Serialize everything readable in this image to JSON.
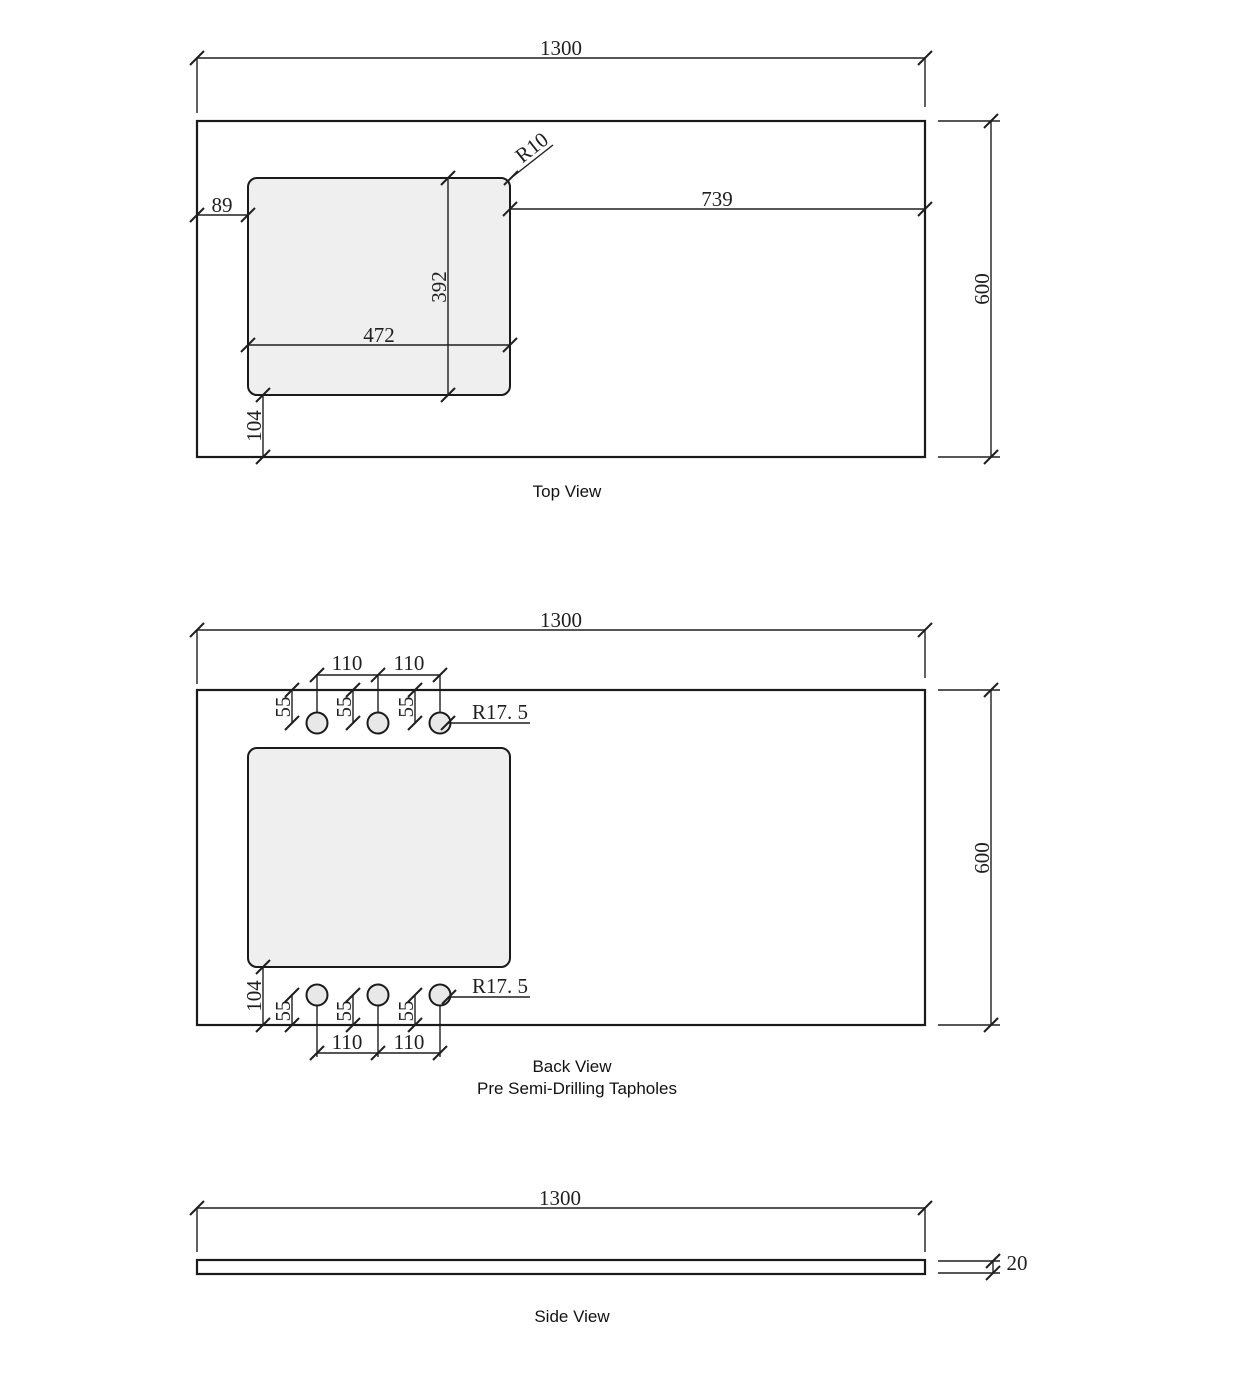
{
  "views": {
    "top": {
      "label": "Top View",
      "dims": {
        "width": "1300",
        "height": "600",
        "cutout_width": "472",
        "cutout_height": "392",
        "offset_left": "89",
        "offset_right": "739",
        "offset_bottom": "104",
        "corner_radius": "R10"
      }
    },
    "back": {
      "label": "Back View",
      "sublabel": "Pre Semi-Drilling Tapholes",
      "dims": {
        "width": "1300",
        "height": "600",
        "hole_pitch": "110",
        "hole_edge_offset": "55",
        "hole_radius": "R17. 5",
        "cutout_offset_bottom": "104"
      }
    },
    "side": {
      "label": "Side View",
      "dims": {
        "width": "1300",
        "thickness": "20"
      }
    }
  },
  "colors": {
    "line": "#1f1f1f",
    "cutout_fill": "#efefef",
    "hole_fill": "#e8e8e8",
    "background": "#ffffff"
  }
}
